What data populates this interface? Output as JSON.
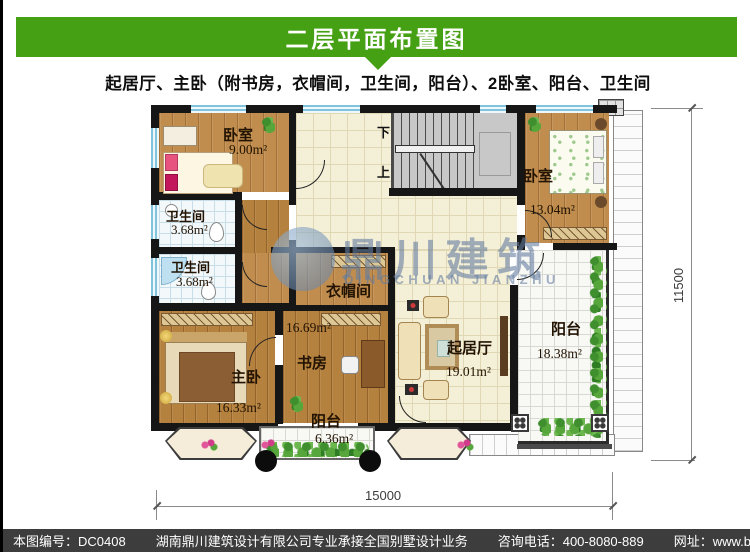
{
  "header": {
    "title": "二层平面布置图",
    "subtitle": "起居厅、主卧（附书房，衣帽间，卫生间，阳台）、2卧室、阳台、卫生间"
  },
  "colors": {
    "banner_green": "#46a013",
    "footer_bg": "#3d3d3d",
    "wall_black": "#161616",
    "window_blue": "#7fc4dc"
  },
  "plan": {
    "rooms": [
      {
        "id": "bedroom-top-left",
        "name": "卧室",
        "area": "9.00m²"
      },
      {
        "id": "bathroom-1",
        "name": "卫生间",
        "area": "3.68m²"
      },
      {
        "id": "bathroom-2",
        "name": "卫生间",
        "area": "3.68m²"
      },
      {
        "id": "bedroom-top-right",
        "name": "卧室",
        "area": "13.04m²"
      },
      {
        "id": "cloakroom",
        "name": "衣帽间",
        "area": ""
      },
      {
        "id": "study",
        "name": "书房",
        "area": "16.69m²"
      },
      {
        "id": "master-bedroom",
        "name": "主卧",
        "area": "16.33m²"
      },
      {
        "id": "living-room",
        "name": "起居厅",
        "area": "19.01m²"
      },
      {
        "id": "balcony-right",
        "name": "阳台",
        "area": "18.38m²"
      },
      {
        "id": "balcony-bottom",
        "name": "阳台",
        "area": "6.36m²"
      }
    ],
    "stairs": {
      "down": "下",
      "up": "上"
    },
    "dimensions": {
      "width": "15000",
      "height": "11500"
    },
    "watermark": {
      "cn": "鼎川建筑",
      "en": "DINGCHUAN JIANZHU"
    }
  },
  "footer": {
    "drawing_no": "本图编号：DC0408",
    "company": "湖南鼎川建筑设计有限公司专业承接全国别墅设计业务",
    "phone": "咨询电话：400-8080-889",
    "website": "网址：www.bstzcs.com"
  }
}
